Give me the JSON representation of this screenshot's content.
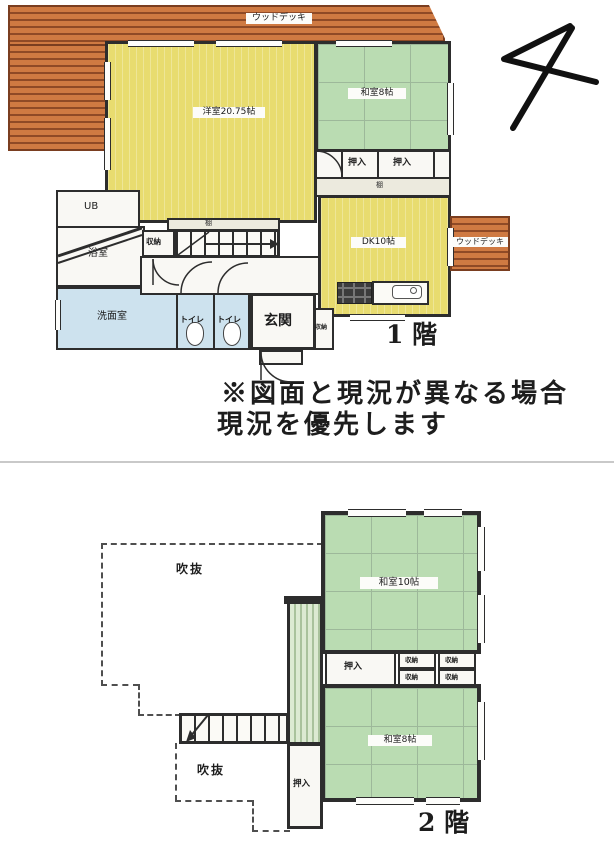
{
  "page": {
    "note_line1": "※図面と現況が異なる場合",
    "note_line2": "現況を優先します",
    "handwritten_number": "4",
    "floor1_caption": "1 階",
    "floor2_caption": "2 階"
  },
  "colors": {
    "deck_base": "#cf7a42",
    "deck_stripe": "#8f4a26",
    "flooring_yellow": "#e8dc6f",
    "tatami_green": "#badcb2",
    "water_blue": "#cde2ee",
    "roof_stripe_green": "#a9c29c",
    "wall": "#2d2d2d"
  },
  "floor1": {
    "deck_top": "ウッドデッキ",
    "deck_right": "ウッドデッキ",
    "living": "洋室20.75帖",
    "japanese_room": "和室8帖",
    "dk": "DK10帖",
    "ub": "UB",
    "bath": "浴室",
    "washroom": "洗面室",
    "entrance": "玄関",
    "toilet": "トイレ",
    "closet": "押入",
    "storage": "収納",
    "shelf": "棚"
  },
  "floor2": {
    "void": "吹抜",
    "japanese_room_10": "和室10帖",
    "japanese_room_8": "和室8帖",
    "closet": "押入",
    "storage": "収納"
  }
}
